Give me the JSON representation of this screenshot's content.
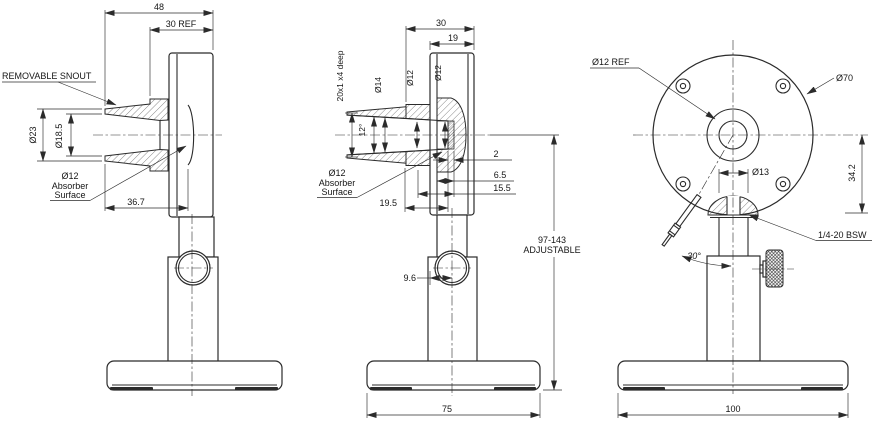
{
  "colors": {
    "line": "#2b2b2b",
    "background": "#ffffff"
  },
  "side_view": {
    "dim_overall_depth": "48",
    "dim_body_depth": "30 REF",
    "label_removable_snout": "REMOVABLE SNOUT",
    "dim_snout_outer_dia": "Ø23",
    "dim_snout_inner_dia": "Ø18.5",
    "absorber_line1": "Ø12",
    "absorber_line2": "Absorber",
    "absorber_line3": "Surface",
    "dim_absorber_depth": "36.7"
  },
  "section_view": {
    "dim_total_depth": "30",
    "dim_body": "19",
    "dim_thread": "20x1 x4 deep",
    "dim_dia_14": "Ø14",
    "dim_dia_12_bore": "Ø12",
    "dim_dia_12_absorber": "Ø12",
    "dim_taper_angle": "12°",
    "absorber_line1": "Ø12",
    "absorber_line2": "Absorber",
    "absorber_line3": "Surface",
    "dim_2": "2",
    "dim_6_5": "6.5",
    "dim_15_5": "15.5",
    "dim_19_5": "19.5",
    "dim_9_6": "9.6",
    "adjustable_range": "97-143",
    "adjustable_word": "ADJUSTABLE",
    "dim_base_depth": "75"
  },
  "front_view": {
    "dim_aperture": "Ø12 REF",
    "dim_body_dia": "Ø70",
    "dim_post_dia": "Ø13",
    "dim_center_height": "34.2",
    "dim_cable_angle": "30°",
    "label_mount_thread": "1/4-20 BSW",
    "dim_base_width": "100"
  }
}
